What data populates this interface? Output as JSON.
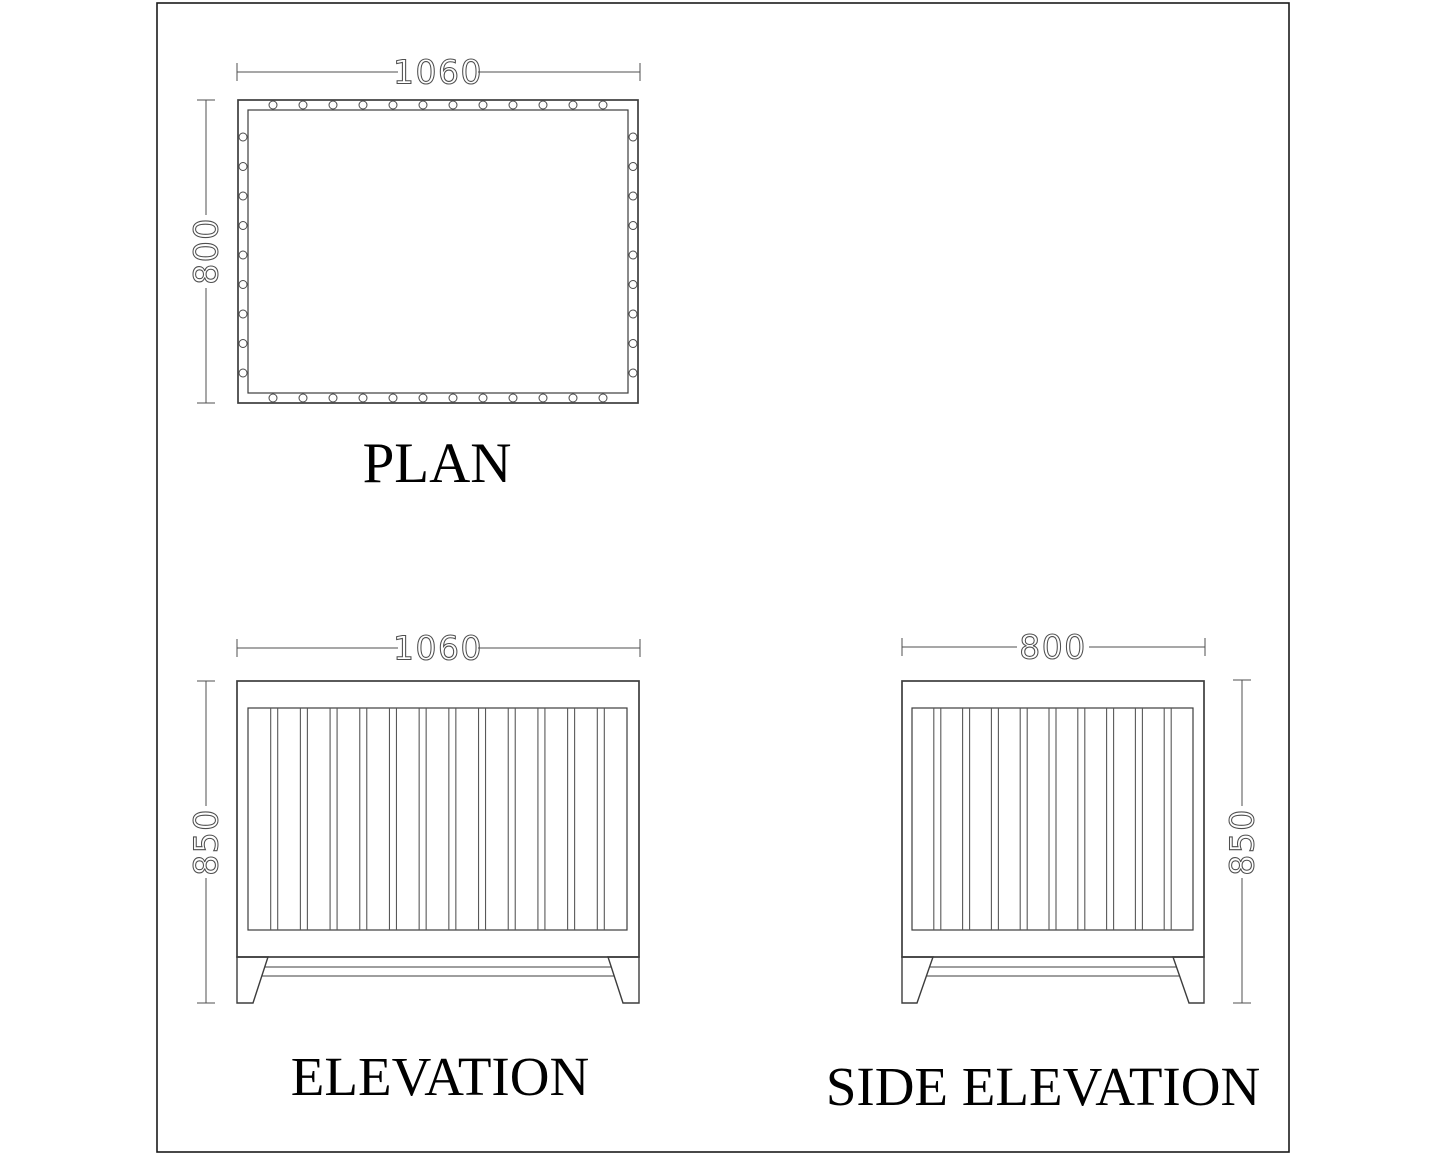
{
  "drawing": {
    "colors": {
      "line": "#3d3d3d",
      "dimension": "#4f4f4f",
      "label": "#000000",
      "background": "#ffffff"
    },
    "views": {
      "plan": {
        "label": "PLAN",
        "width_dim": "1060",
        "height_dim": "800",
        "top_hole_count": 12,
        "bottom_hole_count": 12,
        "left_hole_count": 9,
        "right_hole_count": 9
      },
      "elevation": {
        "label": "ELEVATION",
        "width_dim": "1060",
        "height_dim": "850",
        "slat_count": 12
      },
      "side_elevation": {
        "label": "SIDE ELEVATION",
        "width_dim": "800",
        "height_dim": "850",
        "slat_count": 9
      }
    }
  }
}
